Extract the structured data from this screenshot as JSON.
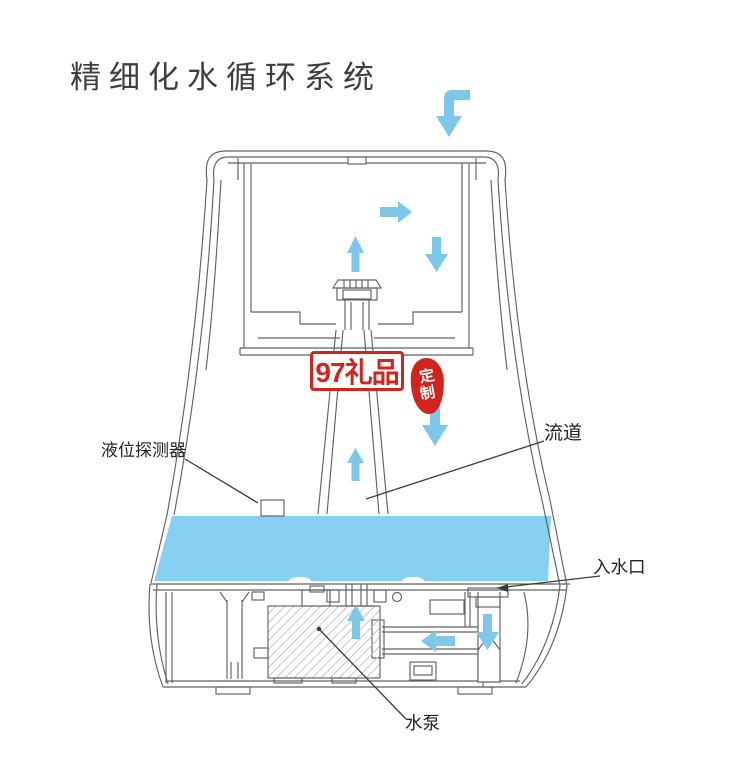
{
  "title": "精细化水循环系统",
  "diagram": {
    "labels": {
      "level_sensor": "液位探测器",
      "flow_channel": "流道",
      "water_inlet": "入水口",
      "water_pump": "水泵"
    },
    "arrow_icons": [
      "top-inflow-elbow-arrow",
      "chamber-right-arrow",
      "chamber-up-arrow",
      "chamber-down-arrow",
      "channel-down-arrow",
      "mist-tube-up-arrow",
      "atomizer-up-arrow",
      "pipe-left-arrow",
      "inlet-down-arrow"
    ],
    "colors": {
      "flow_blue": "#7cc7ea",
      "water_blue": "#87cff1",
      "line_gray": "#606164",
      "watermark_red": "#d2241f"
    }
  },
  "watermark": {
    "badge": "97礼品",
    "seal": {
      "line1": "定",
      "line2": "制"
    }
  }
}
